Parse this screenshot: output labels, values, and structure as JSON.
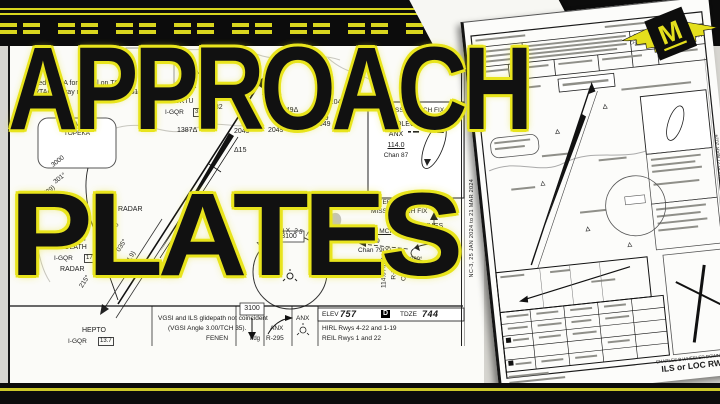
{
  "colors": {
    "accent_yellow": "#e8e41c",
    "stripe_yellow": "#d9d61e",
    "bar_black": "#0c0c0c",
    "paper_white": "#fbfbf8"
  },
  "title": {
    "line1": "APPROACH",
    "line2": "PLATES"
  },
  "logo": {
    "letter": "M"
  },
  "left_plate": {
    "top_fragments": {
      "loc": "I-OC",
      "offset": "offset 2.1"
    },
    "notes": {
      "na1": "Procedure NA for arrival on TOP",
      "na2": "VORTAC airway radials 072 CW 131."
    },
    "cfmg": "(CFMG)",
    "obstacles": [
      "1393Δ",
      "1084Δ",
      "982",
      "Δ1161",
      "2049Δ",
      "Δ2049",
      "2049",
      "1387Δ",
      "ΔΔ",
      "2049",
      "2049",
      "2049",
      "Δ15"
    ],
    "wktu": {
      "name": "WKTU",
      "navaid": "I-GQR",
      "dme": "3.4"
    },
    "topeka": {
      "iaf": "IAF",
      "name": "TOPEKA"
    },
    "feeder": {
      "alt": "3000",
      "crs": "301°",
      "dist": "(29)"
    },
    "radar_upper": "RADAR",
    "olath": {
      "iaf": "[IAF]",
      "name": "OLATH",
      "navaid": "I-GQR",
      "dme": "17.5",
      "radar": "RADAR"
    },
    "beam": {
      "alt": "3000",
      "crs": "035°",
      "dist": "(4.9)",
      "recip": "215°"
    },
    "msa": {
      "arc": "MSA ANX 25 NM",
      "alt": "3100"
    },
    "missed": {
      "title": "MISSED APCH FIX",
      "fix": "NAPOLEON",
      "navaid": "ANX",
      "freq": "114.0",
      "chan": "Chan 87"
    },
    "alternate": {
      "t1": "ALTERNATE",
      "t2": "MISSED APCH FIX",
      "freq": "113.25 MCI",
      "radial": "R-089",
      "chan": "Chan 79(Y)",
      "fix": "LYMES",
      "navaid": "MCI",
      "dme": "39.2",
      "inbound": "269°",
      "outbound": "089°",
      "vfreq": "114.0 ANX",
      "vradial": "R-358",
      "vchan": "Chan 87"
    },
    "profile": {
      "fix": "HEPTO",
      "navaid": "I-GQR",
      "dme": "13.7",
      "note1": "VGSI and ILS glidepath not coincident",
      "note2": "(VGSI Angle 3.00/TCH 35).",
      "fix2": "FENEN",
      "alt": "3100",
      "hdg": "hdg",
      "anx1": "ANX",
      "anx2": "R-295",
      "anx3": "ANX"
    },
    "airport": {
      "elev_label": "ELEV",
      "elev": "757",
      "sym": "D",
      "tdze_label": "TDZE",
      "tdze": "744",
      "l1": "HIRL Rwys 4-22 and 1-19",
      "l2": "REIL Rwys 1 and 22"
    },
    "date_strip": "NC-3, 25 JAN 2024 to 21 MAR 2024"
  },
  "right_plate": {
    "airport_header": "CHARLES B WHEELER DOWNTOWN",
    "airport_footer": "CHARLES B WHEELER DOWNTOWN",
    "title": "ILS or LOC RWY 4",
    "date_strip": "NC-3, 25 JAN 2024 to 21 MAR 2024"
  }
}
